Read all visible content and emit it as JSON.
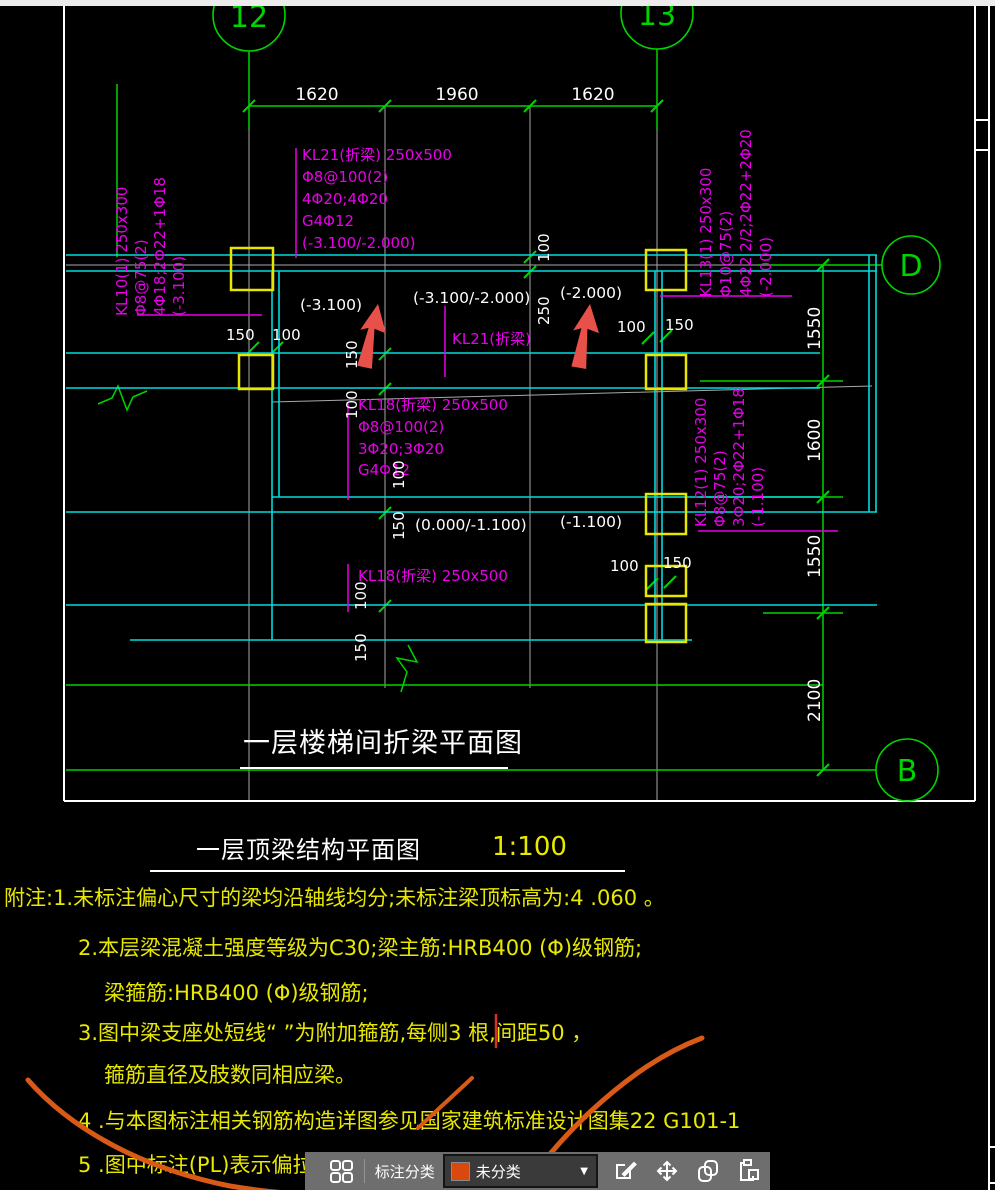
{
  "drawing": {
    "axis_bubbles": {
      "col_left": "12",
      "col_right": "13",
      "row_top": "D",
      "row_bottom": "B"
    },
    "dims": {
      "top": [
        "1620",
        "1960",
        "1620"
      ],
      "right": [
        "1550",
        "1600",
        "1550",
        "2100"
      ],
      "d150": "150",
      "d100": "100",
      "d250": "250"
    },
    "elevations": {
      "e1": "(-3.100)",
      "e2": "(-3.100/-2.000)",
      "e3": "(-2.000)",
      "e4": "(0.000/-1.100)",
      "e5": "(-1.100)"
    },
    "beams": {
      "kl21_block": [
        "KL21(折梁) 250x500",
        "Φ8@100(2)",
        "4Φ20;4Φ20",
        "G4Φ12",
        "(-3.100/-2.000)"
      ],
      "kl21_mid_label": "KL21(折梁)",
      "kl18_block": [
        "KL18(折梁) 250x500",
        "Φ8@100(2)",
        "3Φ20;3Φ20",
        "G4Φ12"
      ],
      "kl18_bottom_label": "KL18(折梁) 250x500",
      "kl10_block": [
        "KL10(1) 250x300",
        "Φ8@75(2)",
        "4Φ18;2Φ22+1Φ18",
        "(-3.100)"
      ],
      "kl13_block": [
        "KL13(1) 250x300",
        "Φ10@75(2)",
        "4Φ22 2/2;2Φ22+2Φ20",
        "(-2.000)"
      ],
      "kl12_block": [
        "KL12(1) 250x300",
        "Φ8@75(2)",
        "3Φ20;2Φ22+1Φ18",
        "(-1.100)"
      ]
    },
    "titles": {
      "inner": "一层楼梯间折梁平面图",
      "outer": "一层顶梁结构平面图",
      "scale": "1:100"
    }
  },
  "notes": {
    "line1": "附注:1.未标注偏心尺寸的梁均沿轴线均分;未标注梁顶标高为:4 .060 。",
    "line2": "2.本层梁混凝土强度等级为C30;梁主筋:HRB400 (Φ)级钢筋;",
    "line3": "梁箍筋:HRB400 (Φ)级钢筋;",
    "line4": "3.图中梁支座处短线“ ”为附加箍筋,每侧3 根,间距50 ，",
    "line5": "箍筋直径及肢数同相应梁。",
    "line6": "4 .与本图标注相关钢筋构造详图参见国家建筑标准设计图集22 G101-1",
    "line7": "5 .图中标注(PL)表示偏拉构件,偏拉构件纵向钢筋接头采用绑扎连接"
  },
  "toolbar": {
    "category_label": "标注分类",
    "dropdown_value": "未分类",
    "dropdown_caret": "▼",
    "swatch_color": "#d9480f"
  },
  "colors": {
    "axis_green": "#00d400",
    "beam_cyan": "#00dcdc",
    "column_yellow": "#e6e600",
    "annotation_magenta": "#e800e8",
    "note_yellow": "#e8e800",
    "dim_white": "#ffffff",
    "arrow_red": "#e8514a",
    "scribble_orange": "#d95a17",
    "toolbar_gray": "#6e6e6e"
  }
}
